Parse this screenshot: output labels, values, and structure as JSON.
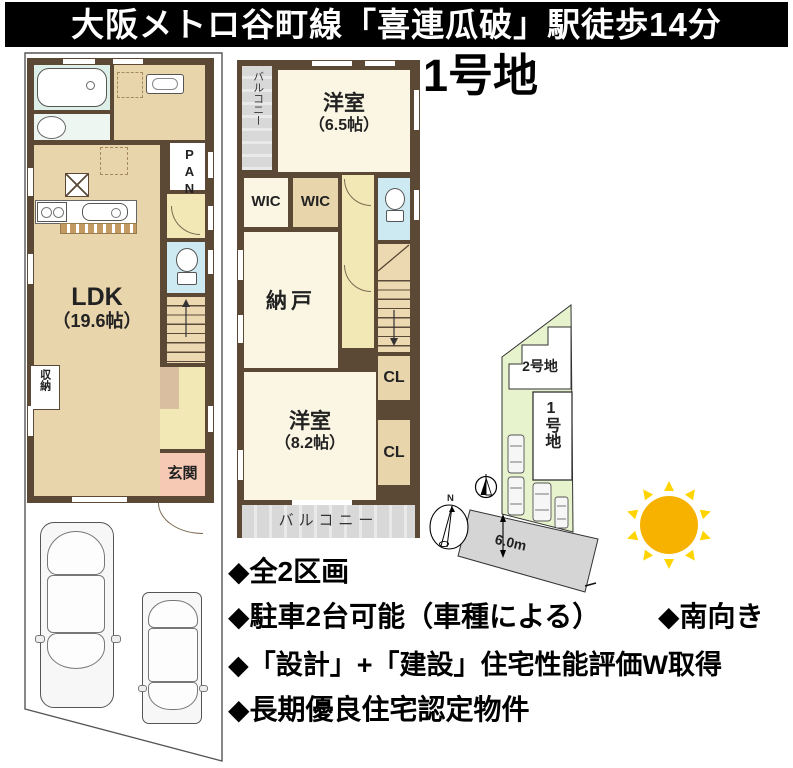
{
  "banner": {
    "text": "大阪メトロ谷町線「喜連瓜破」駅徒歩14分"
  },
  "lot_title": "1号地",
  "floor1": {
    "ldk": "LDK",
    "ldk_size": "（19.6帖）",
    "pantry": "PAN",
    "storage": "収納",
    "entrance": "玄関"
  },
  "floor2": {
    "balcony_top": "バルコニー",
    "room1": "洋室",
    "room1_size": "（6.5帖）",
    "wic1": "WIC",
    "wic2": "WIC",
    "storeroom": "納戸",
    "cl1": "CL",
    "cl2": "CL",
    "room2": "洋室",
    "room2_size": "（8.2帖）",
    "balcony_bottom": "バルコニー"
  },
  "site": {
    "lot2_label": "2号地",
    "lot1_label": "1号地",
    "road_width": "6.0m",
    "north": "N"
  },
  "features": [
    "◆全2区画",
    "◆駐車2台可能（車種による）",
    "◆南向き",
    "◆「設計」+「建設」住宅性能評価W取得",
    "◆長期優良住宅認定物件"
  ],
  "colors": {
    "wall": "#5b4936",
    "floor_tan": "#e9d5ac",
    "cream": "#fbf5e3",
    "hall_yellow": "#f1e8b5",
    "toilet_blue": "#cde9f1",
    "bath": "#dcefe9",
    "genkan_pink": "#f6c9b5",
    "balcony_gray": "#d8d8d8",
    "site_green": "#e6f3cd",
    "road_gray": "#d5d5d5",
    "sun_orange": "#F7B200",
    "sun_ray": "#FFD400"
  }
}
